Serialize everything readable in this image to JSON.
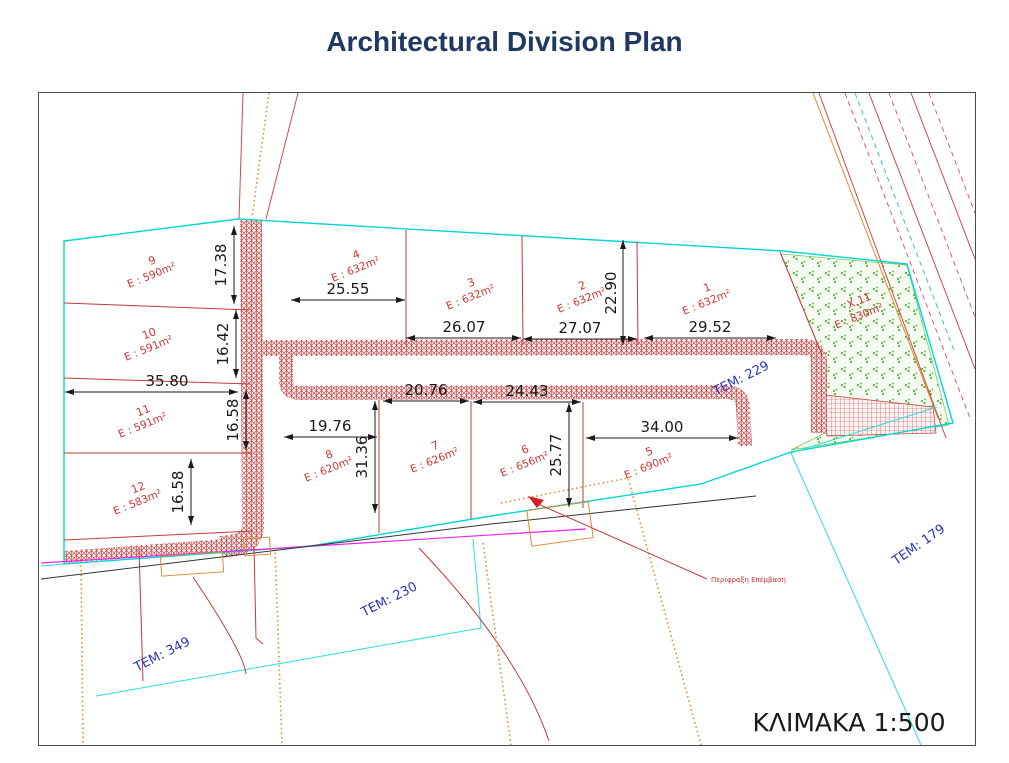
{
  "title": "Architectural Division Plan",
  "scale_label": "ΚΛΙΜΑΚΑ 1:500",
  "plots": [
    {
      "number": "1",
      "area": "E : 632m²"
    },
    {
      "number": "2",
      "area": "E : 632m²"
    },
    {
      "number": "3",
      "area": "E : 632m²"
    },
    {
      "number": "4",
      "area": "E : 632m²"
    },
    {
      "number": "5",
      "area": "E : 690m²"
    },
    {
      "number": "6",
      "area": "E : 656m²"
    },
    {
      "number": "7",
      "area": "E : 626m²"
    },
    {
      "number": "8",
      "area": "E : 620m²"
    },
    {
      "number": "9",
      "area": "E : 590m²"
    },
    {
      "number": "10",
      "area": "E : 591m²"
    },
    {
      "number": "11",
      "area": "E : 591m²"
    },
    {
      "number": "12",
      "area": "E : 583m²"
    }
  ],
  "green_area": {
    "label": "X.11",
    "area": "E : 830m²"
  },
  "tem_labels": [
    "TEM: 229",
    "TEM: 230",
    "TEM: 349",
    "TEM: 179"
  ],
  "dimensions": [
    "25.55",
    "26.07",
    "27.07",
    "29.52",
    "22.90",
    "17.38",
    "16.42",
    "35.80",
    "16.58",
    "16.58",
    "19.76",
    "20.76",
    "31.36",
    "24.43",
    "25.77",
    "34.00"
  ],
  "annotations": {
    "fence_note": "Περίφραξη Επέμβαση"
  },
  "colors": {
    "title_navy": "#1f3864",
    "boundary_cyan": "#00d5d5",
    "road_red": "#c13b3b",
    "plot_label_red": "#cc3434",
    "tem_blue": "#2a35bb",
    "magenta": "#ee22ee",
    "fence_orange": "#de8a33",
    "green_area_dot": "#5cb53a"
  }
}
